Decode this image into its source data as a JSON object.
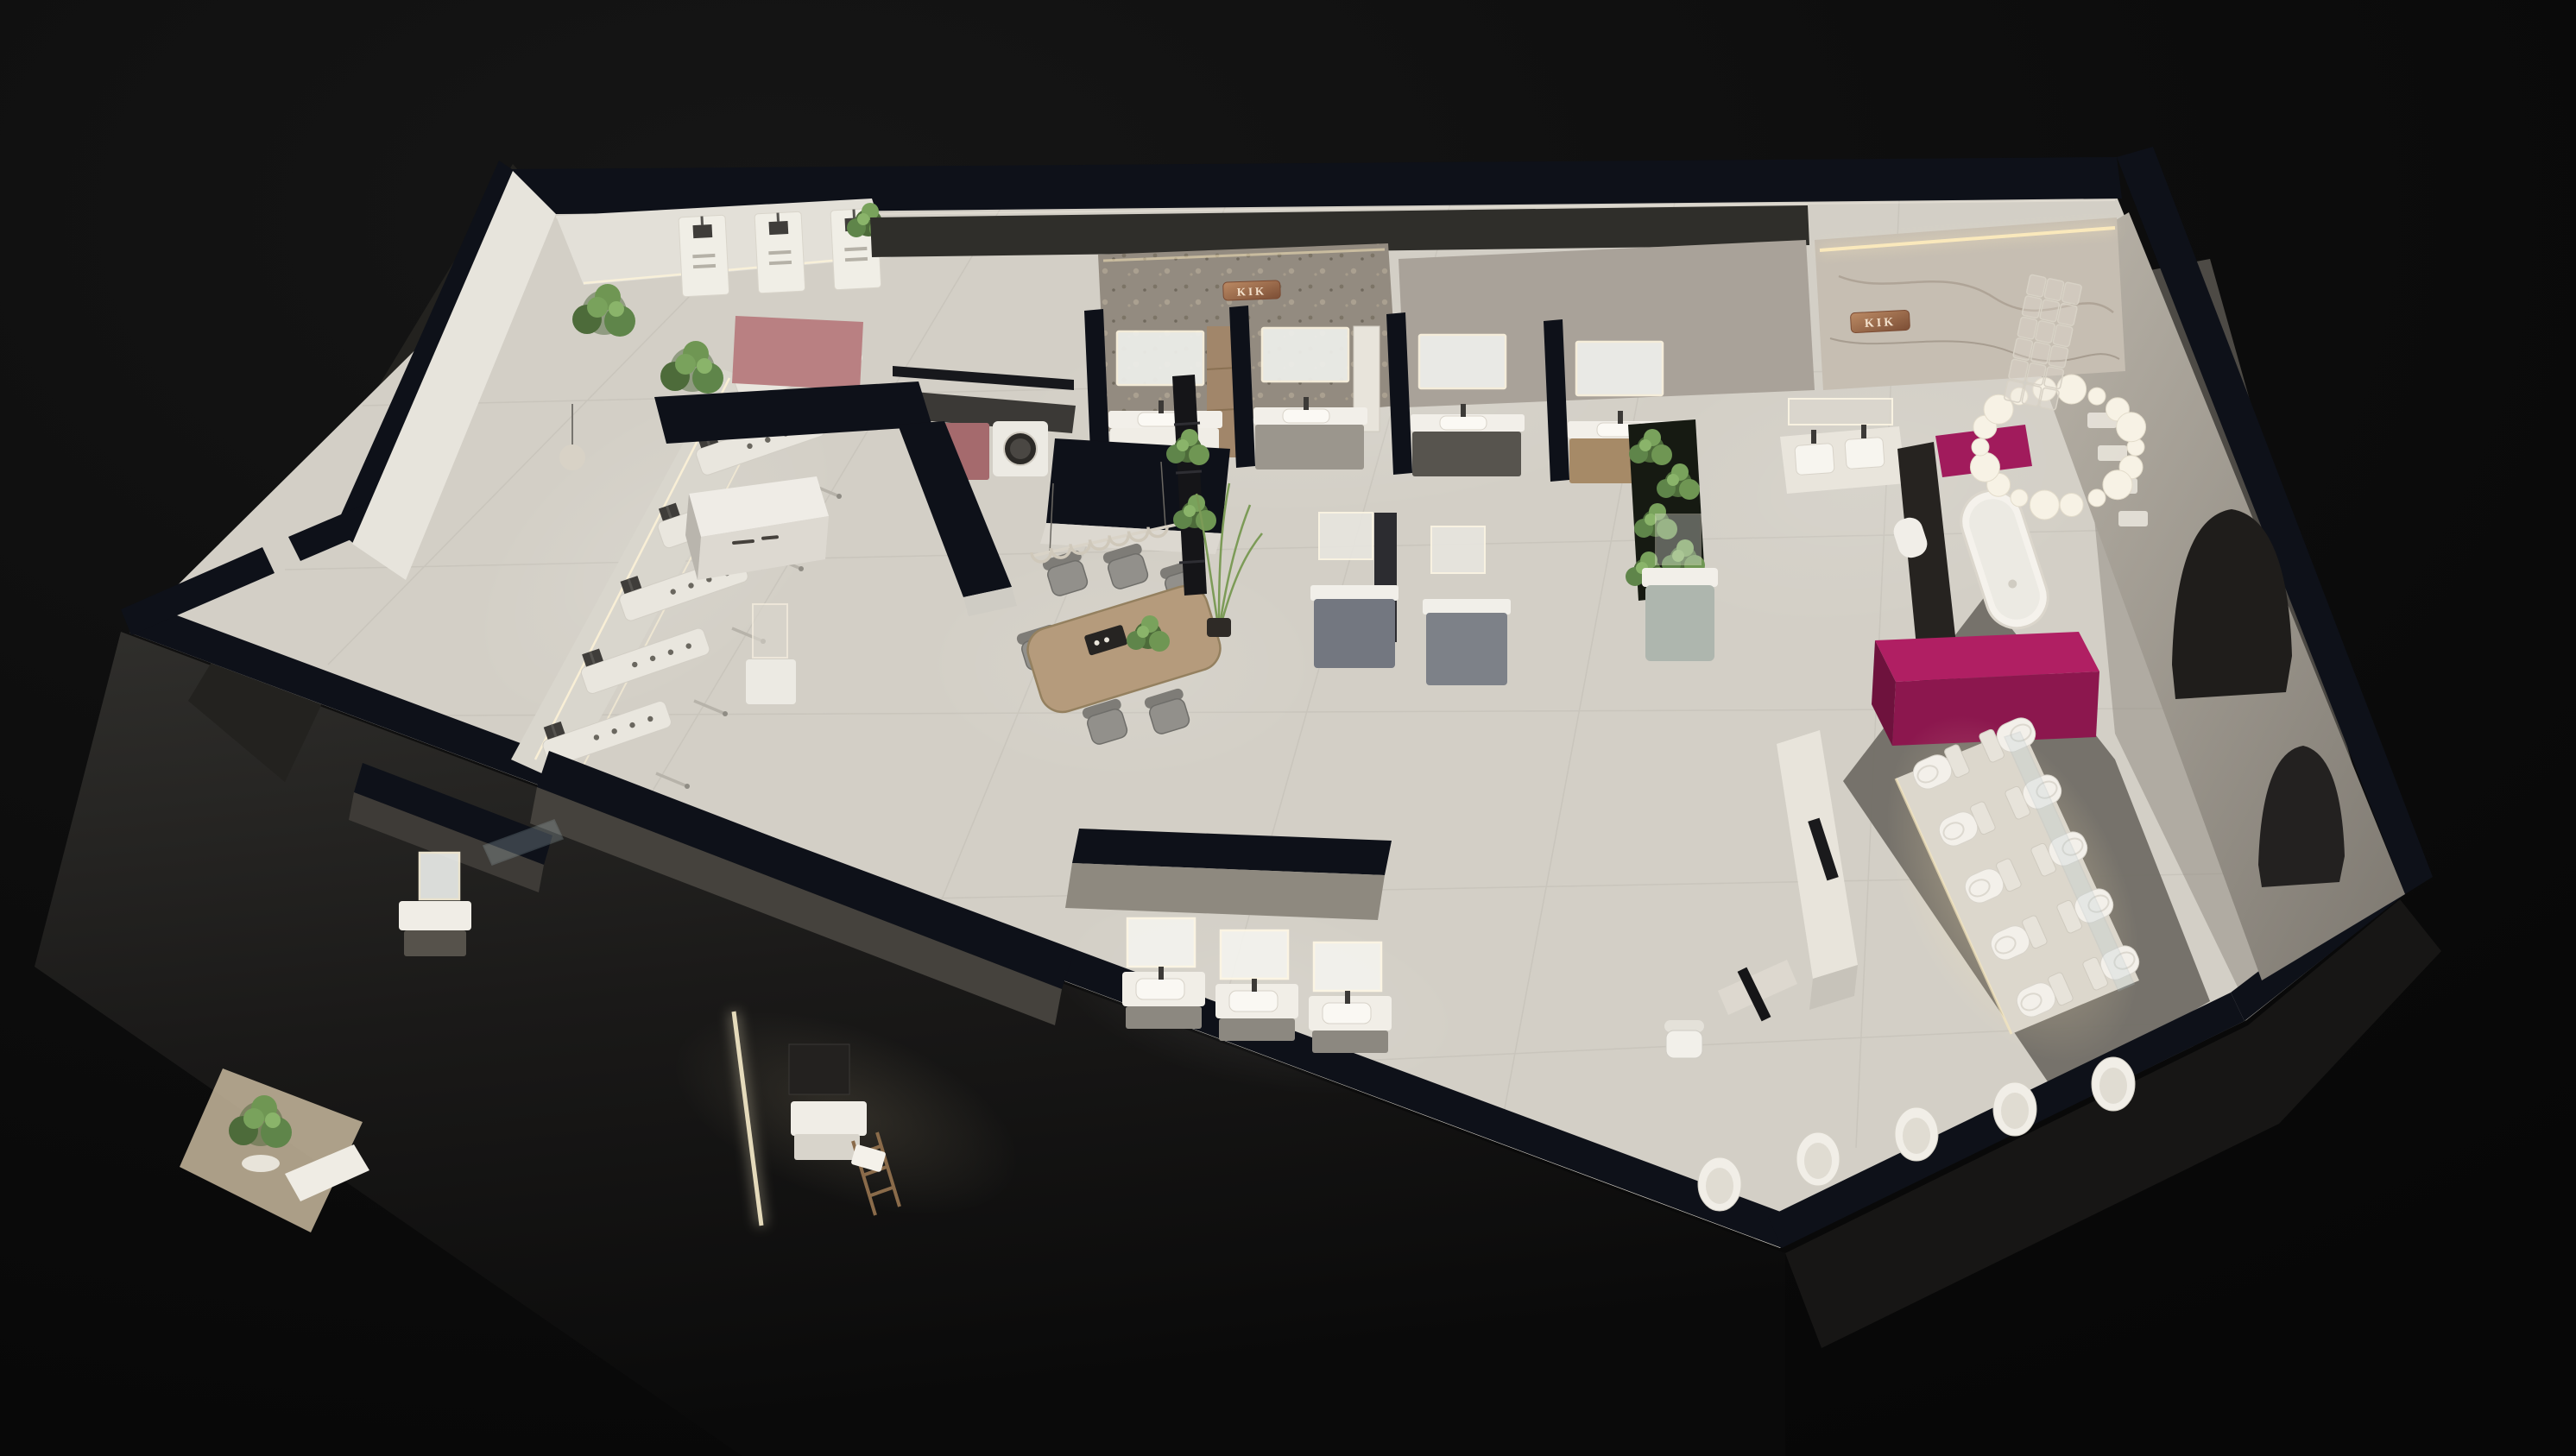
{
  "scene": {
    "description": "3D cutaway floor plan render of a bathroom fixture showroom at night",
    "background": "black void, isometric bird view, interior lit"
  },
  "signage": {
    "stone_wall_sign": "KIK",
    "marble_wall_sign": "KIK"
  },
  "palette": {
    "background": "#0b0b0b",
    "wall_cap_navy": "#0e1119",
    "floor_light": "#d3cfc6",
    "floor_dark_walkway": "#6e6a63",
    "exterior_shadow": "#262523",
    "fixture_white": "#f3f0ea",
    "magenta_accent": "#a81b5e",
    "magenta_dark": "#84154a",
    "dusty_pink": "#b98082",
    "wood_table": "#b59b7c",
    "plant_green": "#5f854a",
    "stone_wall": "#938b80",
    "marble_wall": "#c6beb2",
    "copper_sign": "#9b6b4b",
    "led_glow": "#ffedbe",
    "sage_cabinet": "#aeb6ae",
    "bay_cabinet_colors": [
      "#f0ede6",
      "#9b968d",
      "#57544e",
      "#a68a67"
    ]
  },
  "counts": {
    "toilet_rows": 5,
    "toilet_columns": 2,
    "chandelier_discs": 18,
    "dining_chairs": 6,
    "shower_panels_front": 6,
    "shower_panels_back": 3,
    "hand_shower_rails": 6,
    "wall_hung_basins": 5,
    "vanity_bays_top_row": 4,
    "vanity_units_bottom_row": 3,
    "pendant_arcs": 7,
    "glass_block_cols": 3,
    "glass_block_rows": 6,
    "arch_niches": 2
  }
}
